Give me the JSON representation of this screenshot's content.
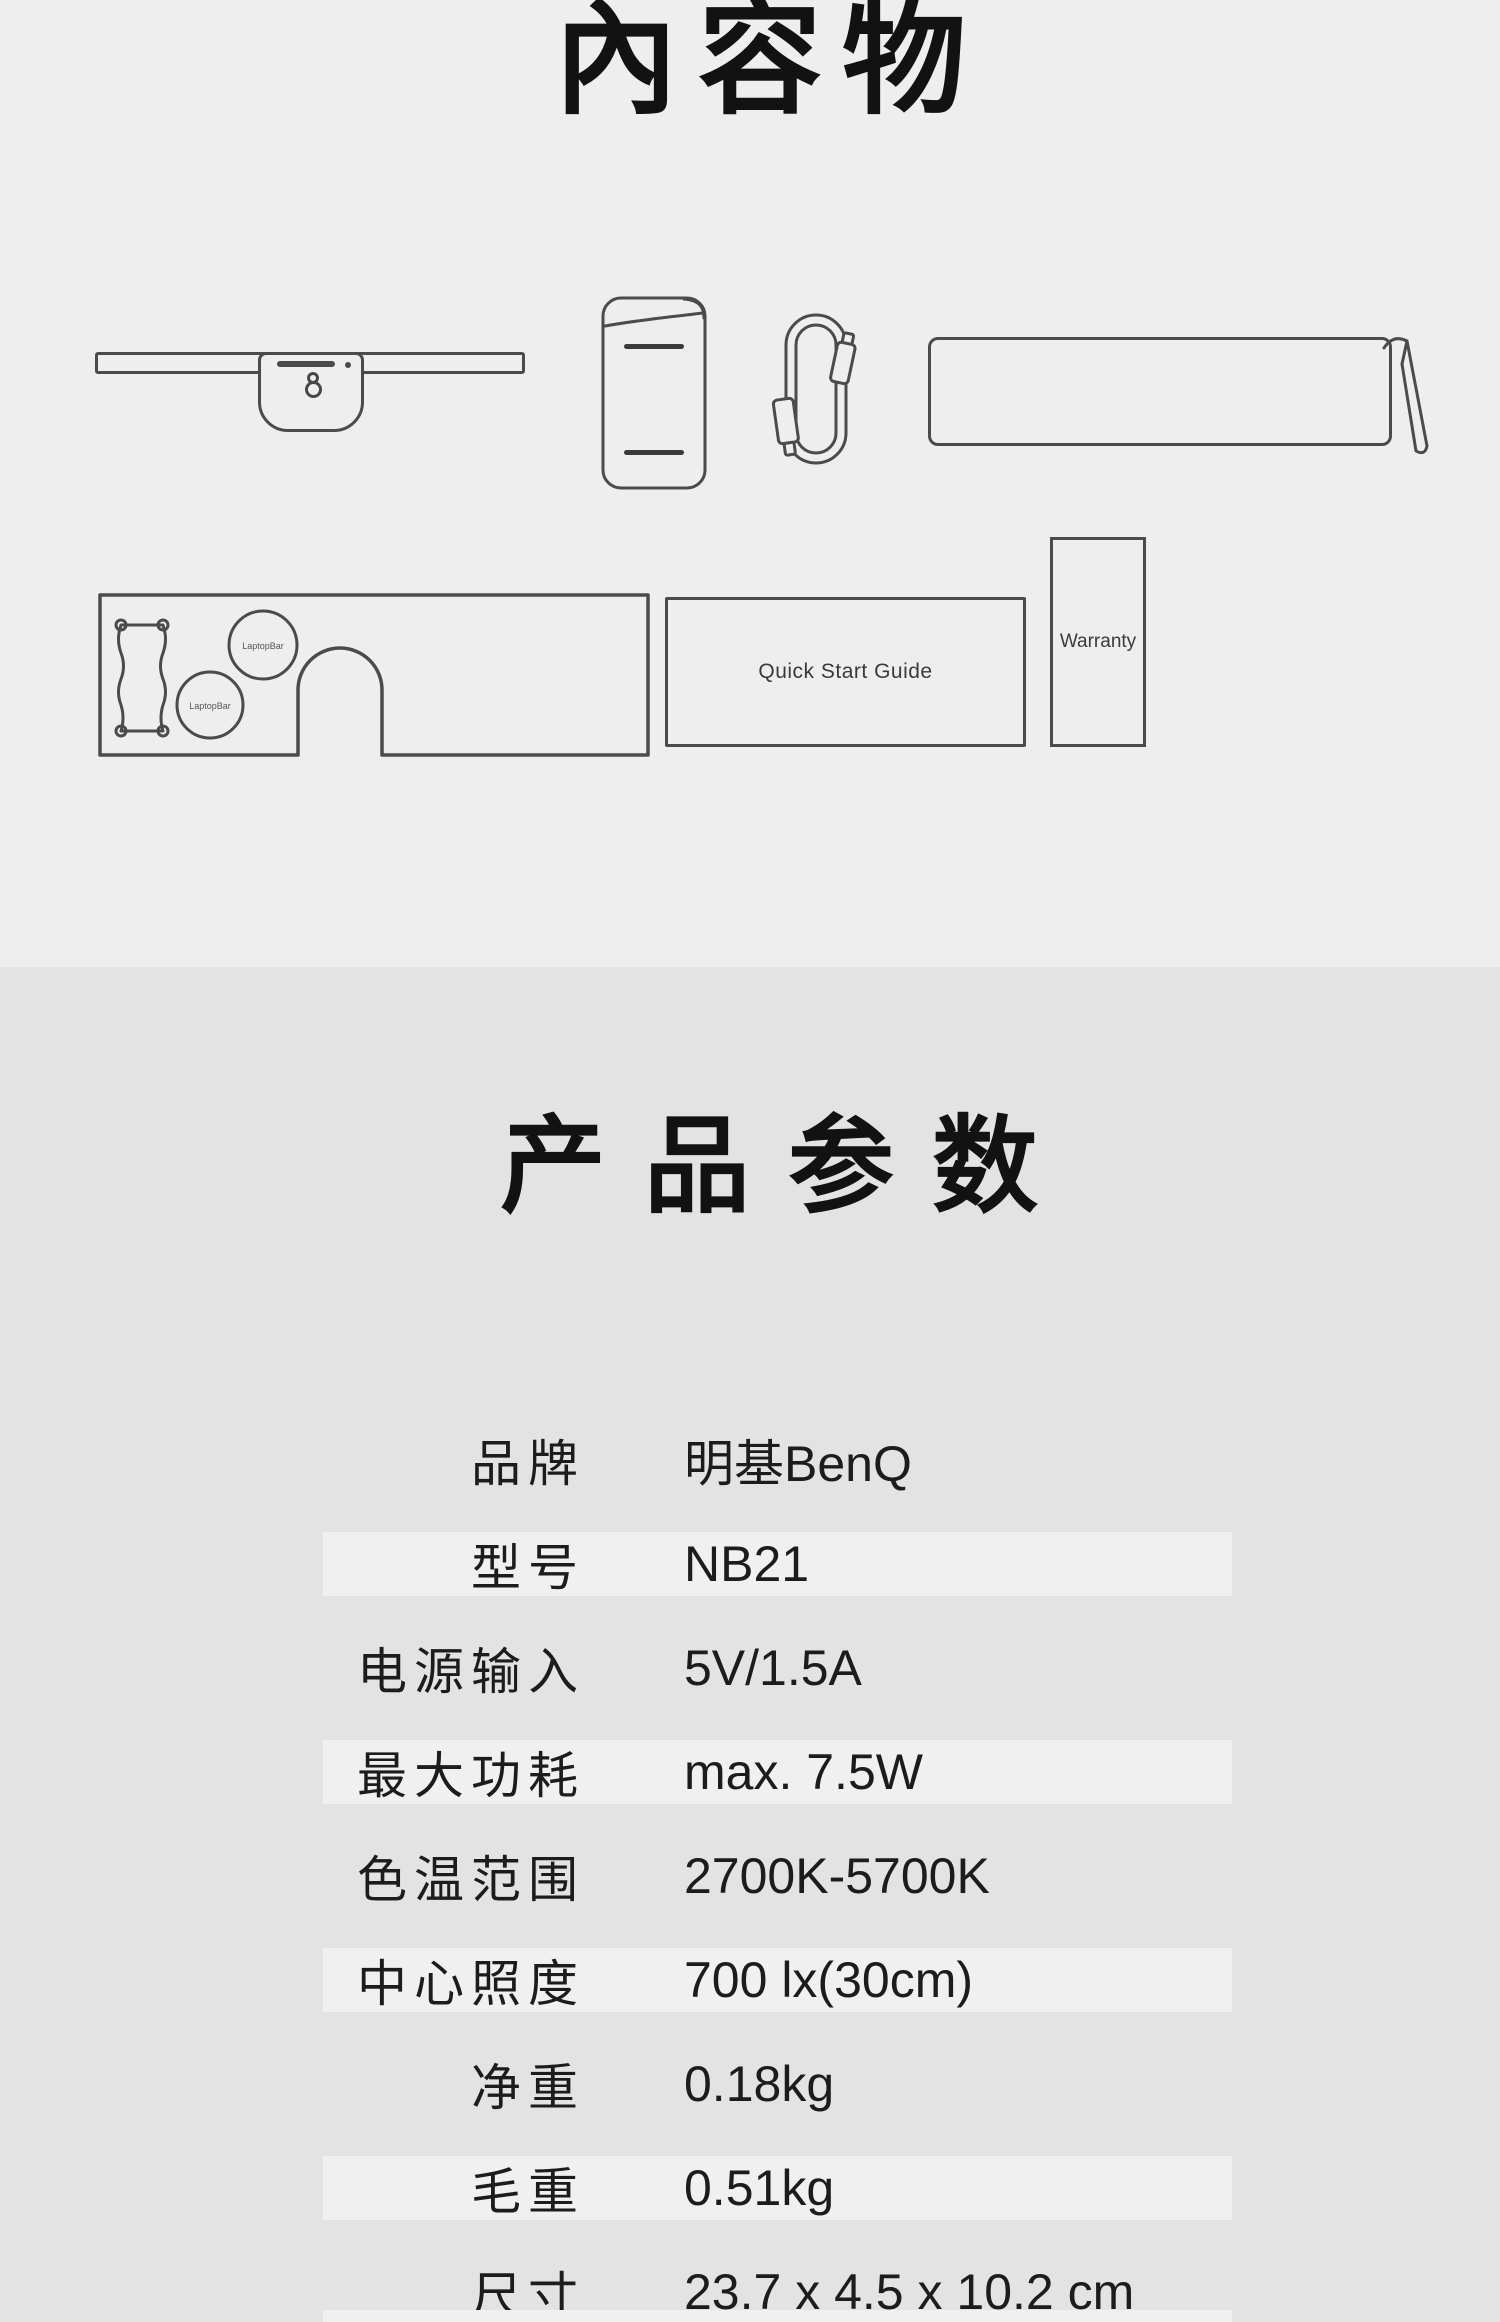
{
  "page": {
    "colors": {
      "background_top": "#EFEEEE",
      "background_bottom": "#E4E3E3",
      "row_stripe": "#F1F0F0",
      "line_art": "#4B4B4B",
      "text": "#1C1C1C"
    }
  },
  "contents": {
    "title": "內容物",
    "laptopbar_circle_label": "LaptopBar",
    "quick_start_guide_label": "Quick Start Guide",
    "warranty_label": "Warranty"
  },
  "specs": {
    "title": "产品参数",
    "rows": [
      {
        "label": "品牌",
        "value": "明基BenQ",
        "striped": false
      },
      {
        "label": "型号",
        "value": "NB21",
        "striped": true
      },
      {
        "label": "电源输入",
        "value": "5V/1.5A",
        "striped": false
      },
      {
        "label": "最大功耗",
        "value": "max. 7.5W",
        "striped": true
      },
      {
        "label": "色温范围",
        "value": "2700K-5700K",
        "striped": false
      },
      {
        "label": "中心照度",
        "value": "700 lx(30cm)",
        "striped": true
      },
      {
        "label": "净重",
        "value": "0.18kg",
        "striped": false
      },
      {
        "label": "毛重",
        "value": "0.51kg",
        "striped": true
      },
      {
        "label": "尺寸",
        "value": "23.7 x 4.5 x 10.2 cm",
        "striped": false
      }
    ]
  }
}
